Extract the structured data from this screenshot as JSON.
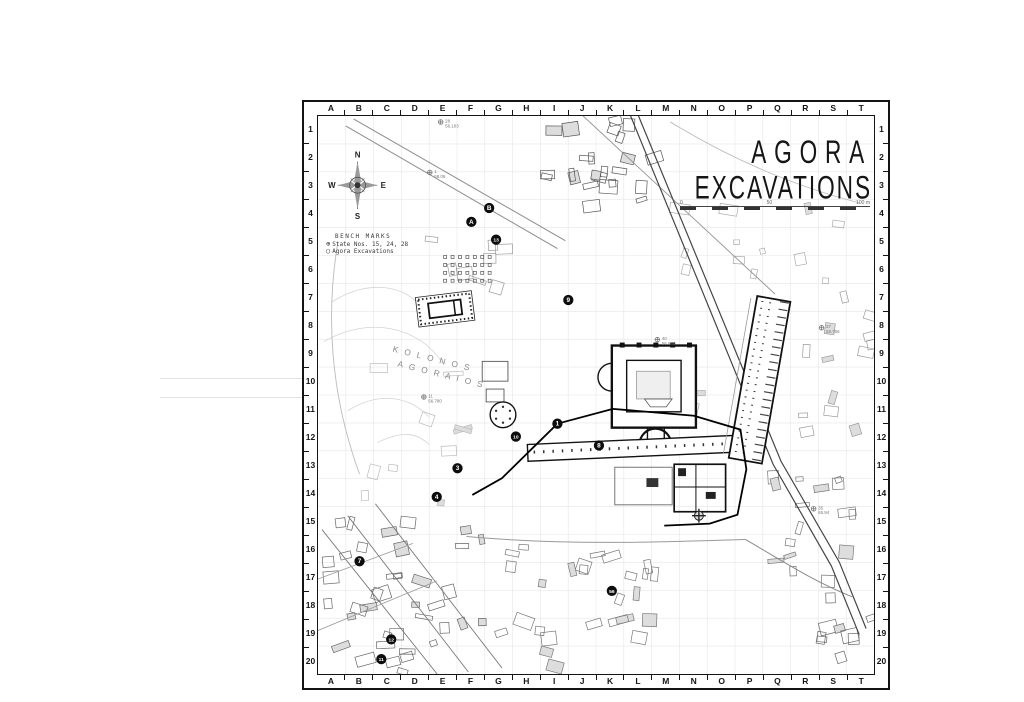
{
  "title": {
    "line1": "AGORA",
    "line2": "EXCAVATIONS"
  },
  "scalebar": {
    "left_label": "0",
    "mid_label": "50",
    "right_label": "100 m"
  },
  "compass": {
    "north": "N",
    "east": "E",
    "south": "S",
    "west": "W"
  },
  "legend": {
    "heading": "BENCH MARKS",
    "items": [
      {
        "symbol": "⊕",
        "label": "State  Nos. 15, 24, 28"
      },
      {
        "symbol": "○",
        "label": "Agora Excavations"
      }
    ]
  },
  "grid": {
    "columns": [
      "A",
      "B",
      "C",
      "D",
      "E",
      "F",
      "G",
      "H",
      "I",
      "J",
      "K",
      "L",
      "M",
      "N",
      "O",
      "P",
      "Q",
      "R",
      "S",
      "T"
    ],
    "rows": [
      "1",
      "2",
      "3",
      "4",
      "5",
      "6",
      "7",
      "8",
      "9",
      "10",
      "11",
      "12",
      "13",
      "14",
      "15",
      "16",
      "17",
      "18",
      "19",
      "20"
    ]
  },
  "map_labels": {
    "kolonos_line1": "K O L O N O S",
    "kolonos_line2": "A G O R A I O S"
  },
  "markers": {
    "letters": [
      {
        "label": "A",
        "x": 155,
        "y": 107
      },
      {
        "label": "B",
        "x": 173,
        "y": 93
      }
    ],
    "numbers": [
      {
        "label": "1",
        "x": 242,
        "y": 311
      },
      {
        "label": "3",
        "x": 141,
        "y": 356
      },
      {
        "label": "4",
        "x": 120,
        "y": 385
      },
      {
        "label": "7",
        "x": 42,
        "y": 450
      },
      {
        "label": "8",
        "x": 284,
        "y": 333
      },
      {
        "label": "9",
        "x": 253,
        "y": 186
      },
      {
        "label": "10",
        "x": 200,
        "y": 324
      },
      {
        "label": "11",
        "x": 64,
        "y": 549
      },
      {
        "label": "12",
        "x": 74,
        "y": 529
      },
      {
        "label": "13",
        "x": 180,
        "y": 125
      },
      {
        "label": "56",
        "x": 297,
        "y": 480
      }
    ]
  },
  "benchmarks": [
    {
      "id": "28",
      "elev": "56.103",
      "x": 124,
      "y": 6
    },
    {
      "id": "1",
      "elev": "58.06",
      "x": 113,
      "y": 57
    },
    {
      "id": "11",
      "elev": "56.780",
      "x": 107,
      "y": 284
    },
    {
      "id": "40",
      "elev": "56.946",
      "x": 343,
      "y": 226
    },
    {
      "id": "37",
      "elev": "58.756",
      "x": 509,
      "y": 214
    },
    {
      "id": "35",
      "elev": "65.94",
      "x": 501,
      "y": 397
    }
  ],
  "colors": {
    "ink": "#141414",
    "mid_gray": "#777777",
    "faint_gray": "#d4d4d4"
  }
}
